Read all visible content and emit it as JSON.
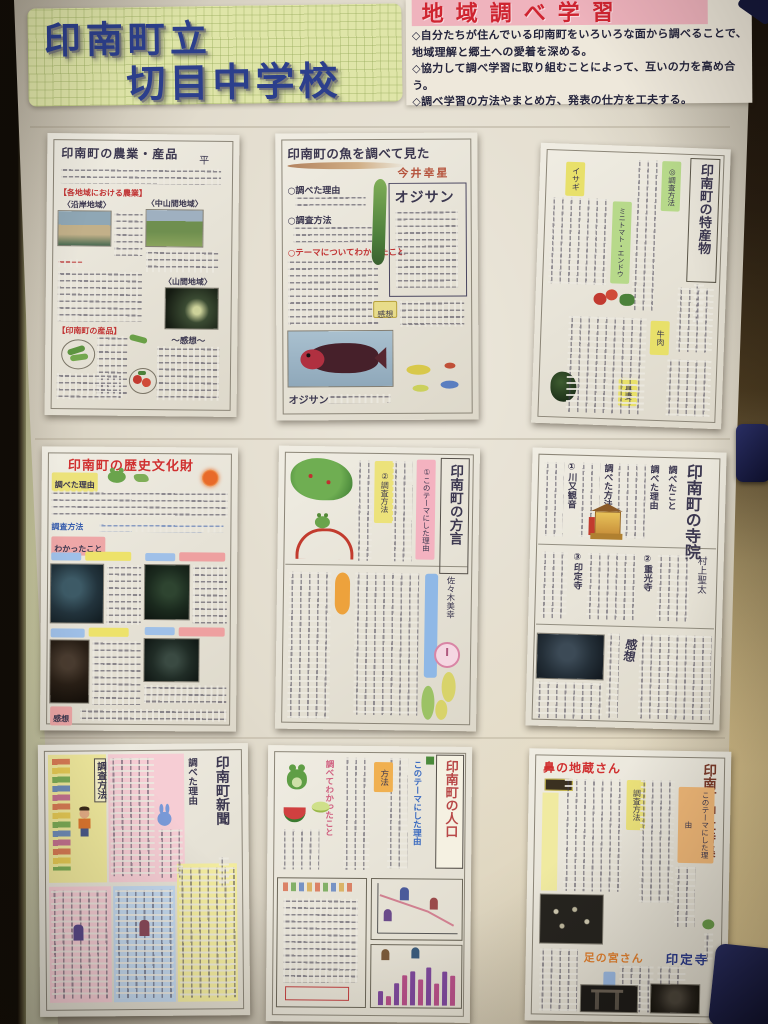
{
  "scene": {
    "type": "photograph of a school bulletin board",
    "description": "Nine handwritten student research sheets about Inami Town displayed on a large white poster, held by navy magnets",
    "colors": {
      "wall_dark": "#231a10",
      "wall_light": "#d9c491",
      "poster": "#e6e0d2",
      "magnet": "#1b2150",
      "ink": "#3c3850"
    }
  },
  "header": {
    "school_sign": {
      "line1": "印南町立",
      "line2": "切目中学校",
      "text_color": "#2c3f8c",
      "bg": "#dfe5a8"
    },
    "unit_sign": {
      "title": "地域調べ学習",
      "title_color": "#cf2430",
      "banner_bg": "#efb3bd",
      "goals": [
        "◇自分たちが住んでいる印南町をいろいろな面から調べることで、地域理解と郷土への愛着を深める。",
        "◇協力して調べ学習に取り組むことによって、互いの力を高め合う。",
        "◇調べ学習の方法やまとめ方、発表の仕方を工夫する。"
      ]
    }
  },
  "sheets": [
    {
      "id": "agriculture",
      "title": "印南町の農業・産品",
      "author": "平",
      "headings": [
        "【各地域における農業】",
        "〈沿岸地域〉",
        "〈中山間地域〉",
        "〈山間地域〉",
        "【印南町の産品】",
        "～感想～"
      ],
      "photos": [
        "coastline",
        "terraced-fields",
        "mountain-greenhouse"
      ],
      "drawings": [
        "pea-pods",
        "tomatoes"
      ]
    },
    {
      "id": "fish",
      "title": "印南町の魚を調べて見た",
      "author": "今井幸星",
      "headings": [
        "○調べた理由",
        "○調査方法",
        "○テーマについてわかったこと"
      ],
      "feature_name": "オジサン",
      "note_label": "感想",
      "photo_caption": "オジサン",
      "drawings": [
        "green-fish",
        "small-fishes"
      ]
    },
    {
      "id": "specialty",
      "title": "印南町の特産物",
      "headings": [
        "◎調査方法"
      ],
      "products": [
        "ミニトマト・エンドウ",
        "牛肉",
        "イサギ",
        "真妻"
      ],
      "drawings": [
        "tomato-and-peas",
        "wasabi"
      ]
    },
    {
      "id": "heritage",
      "title": "印南町の歴史文化財",
      "headings": [
        "調べた理由",
        "調査方法",
        "わかったこと",
        "感想"
      ],
      "photos": [
        "cultural-property-1",
        "cultural-property-2",
        "cultural-property-3",
        "cultural-property-4"
      ],
      "drawings": [
        "sun",
        "frog"
      ]
    },
    {
      "id": "dialect",
      "title": "印南町の方言",
      "author": "佐々木美幸",
      "headings": [
        "①このテーマにした理由",
        "②調査方法"
      ],
      "drawings": [
        "inami-town-map",
        "frog-on-kaeru-bridge",
        "clock"
      ]
    },
    {
      "id": "temples",
      "title": "印南町の寺院",
      "author": "村上聖太",
      "headings": [
        "調べたこと",
        "調べた理由",
        "調べた方法",
        "①川又観音",
        "②重光寺",
        "③印定寺",
        "感想"
      ],
      "photos": [
        "temple"
      ],
      "drawings": [
        "golden-altar"
      ]
    },
    {
      "id": "newspaper",
      "title": "印南町新聞",
      "headings": [
        "調べた理由",
        "調査方法"
      ],
      "drawings": [
        "boy",
        "rabbit",
        "small-figures"
      ]
    },
    {
      "id": "population",
      "title": "印南町の人口",
      "headings": [
        "このテーマにした理由",
        "方法",
        "調べてわかったこと"
      ],
      "drawings": [
        "frog",
        "watermelon",
        "melon-slice",
        "stick-figures"
      ],
      "graphs": {
        "line": "人口の推移（減少）",
        "bar_heights": [
          14,
          9,
          22,
          30,
          34,
          26,
          38,
          22,
          34,
          30
        ]
      }
    },
    {
      "id": "shrines",
      "title": "印南町神社特集",
      "headings": [
        "鼻の地蔵さん",
        "足の宮さん",
        "印定寺",
        "このテーマにした理由",
        "調査方法"
      ],
      "photos": [
        "group-photo",
        "torii-gate",
        "temple-gate"
      ]
    }
  ],
  "magnets": [
    {
      "name": "top-right-corner"
    },
    {
      "name": "right-edge"
    },
    {
      "name": "bottom-right"
    }
  ]
}
